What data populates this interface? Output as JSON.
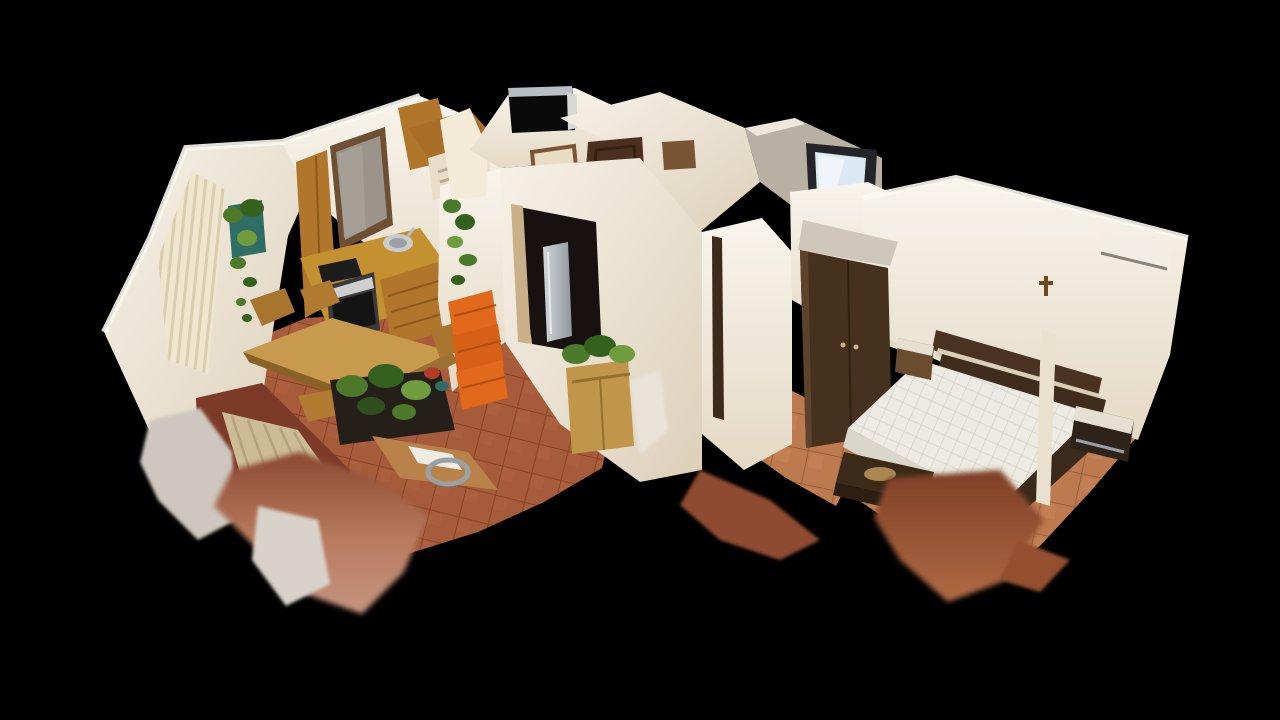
{
  "viewer": {
    "type": "3d-dollhouse-cutaway-view",
    "background_color": "#000000",
    "interaction": "orbit-drag-canvas",
    "content": "photogrammetry scan of a furnished apartment, walls cut at top, seen from above at an oblique angle"
  },
  "scene": {
    "rooms": [
      {
        "id": "living-kitchen",
        "label": "open-plan kitchen and living room (left)",
        "objects": [
          "vertical-blinds-window",
          "wall-plant-arrangement",
          "kitchen-window-brown-frame",
          "upper-wood-cabinets",
          "curved-wood-canopy",
          "range-hood",
          "stainless-sink",
          "black-cooktop",
          "built-in-oven",
          "wood-base-cabinets",
          "stacked-orange-crates",
          "wood-dining-table",
          "wood-chairs",
          "iron-plant-stand-with-plants",
          "sofa-with-striped-beige-cushions",
          "wood-side-table-with-papers-and-tray",
          "terracotta-tile-floor",
          "ragged-scan-underside"
        ]
      },
      {
        "id": "hallway",
        "label": "entry hallway (center)",
        "objects": [
          "bathroom-block-with-dark-niche",
          "open-white-door-panel",
          "entry-door-dark-brown",
          "interior-door-brown",
          "doorway-opening-with-refrigerator",
          "sideboard-with-green-plant",
          "glossy-archway",
          "wall-mounted-tv-glowing",
          "tile-floor",
          "scan-hole-black"
        ]
      },
      {
        "id": "bedroom",
        "label": "bedroom (right)",
        "objects": [
          "dark-brown-wardrobe",
          "archway-sheen",
          "double-mattress-quilted",
          "dark-wood-headboard",
          "nightstand-left",
          "nightstand-right",
          "foot-bench-dark",
          "vertical-light-post",
          "air-conditioner-unit",
          "small-wall-cross",
          "tile-floor",
          "ragged-scan-underside"
        ]
      }
    ]
  },
  "palette": {
    "background": "#000000",
    "wall_bright": "#f6f1e7",
    "wall_mid": "#ece3d2",
    "wall_shade": "#d9cdb8",
    "wood_cabinet": "#b0762c",
    "wood_counter": "#c3912f",
    "wood_table": "#c79a4e",
    "door_dark": "#4b3020",
    "wardrobe": "#46311f",
    "tile_left_room": "#a65b3a",
    "tile_bedroom": "#bd7a4e",
    "mattress": "#eceae2",
    "tv_screen": "#dce9f4",
    "plant_green": "#4d7a2a",
    "crate_orange": "#e2681c",
    "cushion_beige": "#cdbb95",
    "scan_underside": "#9d5b40"
  }
}
